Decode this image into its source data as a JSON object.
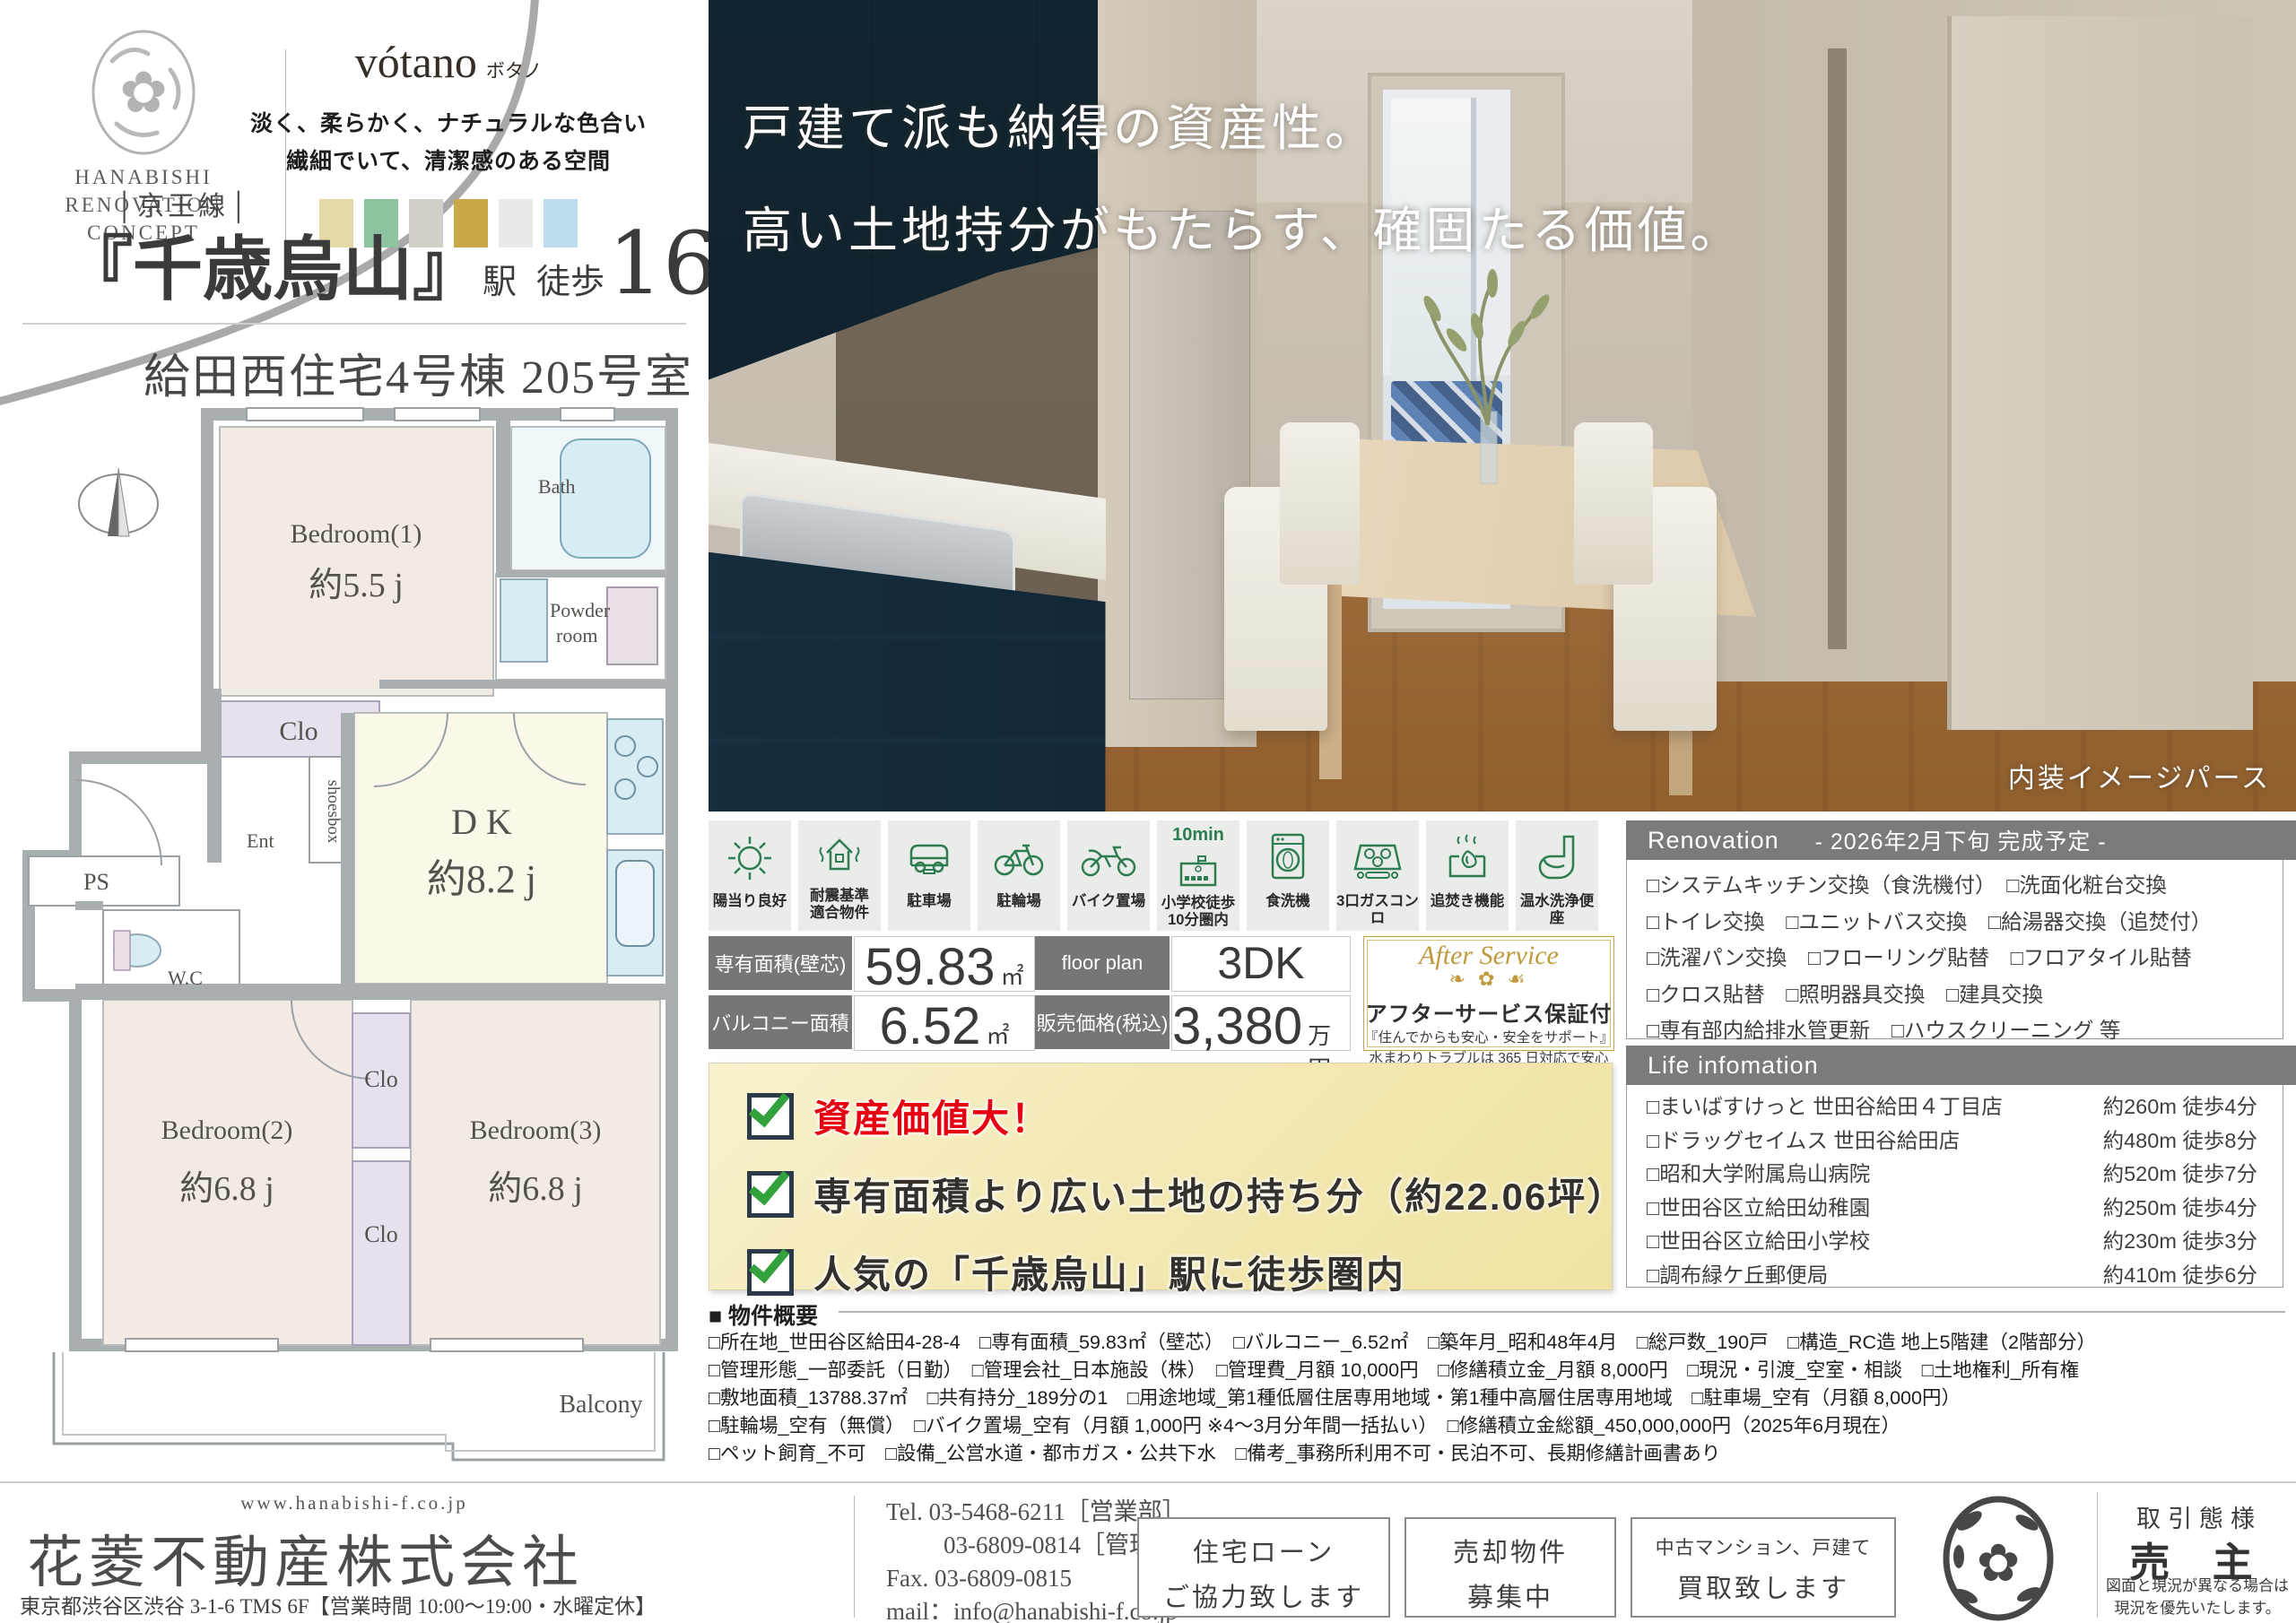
{
  "brand": {
    "logo_lines": [
      "HANABISHI",
      "RENOVATION",
      "CONCEPT"
    ],
    "concept_name": "vótano",
    "concept_kana": "ボタノ",
    "copy1": "淡く、柔らかく、ナチュラルな色合い",
    "copy2": "繊細でいて、清潔感のある空間",
    "swatches": [
      "#e5d9a8",
      "#8ec3a2",
      "#d2cfc8",
      "#c8a847",
      "#e9e9e7",
      "#badcec"
    ]
  },
  "station": {
    "line_name": "│京王線│",
    "station_quoted": "『千歳烏山』",
    "station_suffix": "駅",
    "walk_label": "徒歩",
    "walk_min": "16",
    "min_label": "分"
  },
  "building_title": "給田西住宅4号棟 205号室",
  "floorplan": {
    "bedroom1": "Bedroom(1)",
    "bedroom1_size": "約5.5 j",
    "bath": "Bath",
    "powder1": "Powder",
    "powder2": "room",
    "clo1": "Clo",
    "shoesbox": "shoesbox",
    "ent": "Ent",
    "dk": "D K",
    "dk_size": "約8.2 j",
    "ps": "PS",
    "wc": "W.C",
    "bedroom2": "Bedroom(2)",
    "bedroom2_size": "約6.8 j",
    "clo2": "Clo",
    "clo3": "Clo",
    "bedroom3": "Bedroom(3)",
    "bedroom3_size": "約6.8 j",
    "balcony": "Balcony"
  },
  "photo": {
    "headline1": "戸建て派も納得の資産性。",
    "headline2": "高い土地持分がもたらす、確固たる価値。",
    "caption": "内装イメージパース"
  },
  "features": [
    {
      "icon": "sun-icon",
      "l1": "陽当り良好",
      "l2": "",
      "badge": ""
    },
    {
      "icon": "quake-house-icon",
      "l1": "耐震基準",
      "l2": "適合物件",
      "badge": ""
    },
    {
      "icon": "car-icon",
      "l1": "駐車場",
      "l2": "",
      "badge": ""
    },
    {
      "icon": "bicycle-icon",
      "l1": "駐輪場",
      "l2": "",
      "badge": ""
    },
    {
      "icon": "motorcycle-icon",
      "l1": "バイク置場",
      "l2": "",
      "badge": ""
    },
    {
      "icon": "school-icon",
      "l1": "小学校徒歩",
      "l2": "10分圏内",
      "badge": "10min"
    },
    {
      "icon": "dishwasher-icon",
      "l1": "食洗機",
      "l2": "",
      "badge": ""
    },
    {
      "icon": "stove-icon",
      "l1": "3口ガスコンロ",
      "l2": "",
      "badge": ""
    },
    {
      "icon": "reheat-icon",
      "l1": "追焚き機能",
      "l2": "",
      "badge": ""
    },
    {
      "icon": "toilet-icon",
      "l1": "温水洗浄便座",
      "l2": "",
      "badge": ""
    }
  ],
  "spec_table": {
    "area_label": "専有面積(壁芯)",
    "area_value": "59.83",
    "area_unit": "㎡",
    "plan_label": "floor plan",
    "plan_value": "3DK",
    "balcony_label": "バルコニー面積",
    "balcony_value": "6.52",
    "balcony_unit": "㎡",
    "price_label": "販売価格(税込)",
    "price_value": "3,380",
    "price_unit": "万円"
  },
  "after_service": {
    "title": "After Service",
    "flourish": "❧ ✿ ☙",
    "heading": "アフターサービス保証付",
    "line1": "『住んでからも安心・安全をサポート』",
    "line2": "水まわりトラブルは 365 日対応で安心です"
  },
  "renovation": {
    "title": "Renovation",
    "subtitle": "- 2026年2月下旬 完成予定 -",
    "lines": [
      "□システムキッチン交換（食洗機付）　□洗面化粧台交換",
      "□トイレ交換　□ユニットバス交換　□給湯器交換（追焚付）",
      "□洗濯パン交換　□フローリング貼替　□フロアタイル貼替",
      "□クロス貼替　□照明器具交換　□建具交換",
      "□専有部内給排水管更新　□ハウスクリーニング 等"
    ]
  },
  "life_info": {
    "title": "Life infomation",
    "rows": [
      {
        "name": "□まいばすけっと 世田谷給田４丁目店",
        "dist": "約260m 徒歩4分"
      },
      {
        "name": "□ドラッグセイムス 世田谷給田店",
        "dist": "約480m 徒歩8分"
      },
      {
        "name": "□昭和大学附属烏山病院",
        "dist": "約520m 徒歩7分"
      },
      {
        "name": "□世田谷区立給田幼稚園",
        "dist": "約250m 徒歩4分"
      },
      {
        "name": "□世田谷区立給田小学校",
        "dist": "約230m 徒歩3分"
      },
      {
        "name": "□調布緑ケ丘郵便局",
        "dist": "約410m 徒歩6分"
      }
    ]
  },
  "highlights": [
    {
      "text": "資産価値大！"
    },
    {
      "text": "専有面積より広い土地の持ち分（約22.06坪）"
    },
    {
      "text": "人気の「千歳烏山」駅に徒歩圏内"
    }
  ],
  "overview": {
    "title": "■ 物件概要",
    "lines": [
      "□所在地_世田谷区給田4-28-4　□専有面積_59.83㎡（壁芯）　□バルコニー_6.52㎡　□築年月_昭和48年4月　□総戸数_190戸　□構造_RC造 地上5階建（2階部分）",
      "□管理形態_一部委託（日勤）　□管理会社_日本施設（株）　□管理費_月額 10,000円　□修繕積立金_月額 8,000円　□現況・引渡_空室・相談　□土地権利_所有権",
      "□敷地面積_13788.37㎡　□共有持分_189分の1　□用途地域_第1種低層住居専用地域・第1種中高層住居専用地域　□駐車場_空有（月額 8,000円）",
      "□駐輪場_空有（無償）　□バイク置場_空有（月額 1,000円 ※4～3月分年間一括払い）　□修繕積立金総額_450,000,000円（2025年6月現在）",
      "□ペット飼育_不可　□設備_公営水道・都市ガス・公共下水　□備考_事務所利用不可・民泊不可、長期修繕計画書あり"
    ]
  },
  "footer": {
    "url": "www.hanabishi-f.co.jp",
    "company": "花菱不動産株式会社",
    "address": "東京都渋谷区渋谷 3-1-6 TMS 6F【営業時間 10:00～19:00・水曜定休】",
    "tel1": "Tel. 03-5468-6211［営業部］",
    "tel2": "03-6809-0814［管理部］",
    "fax": "Fax. 03-6809-0815",
    "mail": "mail：info@hanabishi-f.co.jp",
    "box1_l1": "住宅ローン",
    "box1_l2": "ご協力致します",
    "box2_l1": "売却物件",
    "box2_l2": "募集中",
    "box3_l1": "中古マンション、戸建て",
    "box3_l2": "買取致します",
    "deal_label": "取引態様",
    "deal_value": "売 主",
    "deal_note1": "図面と現況が異なる場合は",
    "deal_note2": "現況を優先いたします。"
  }
}
